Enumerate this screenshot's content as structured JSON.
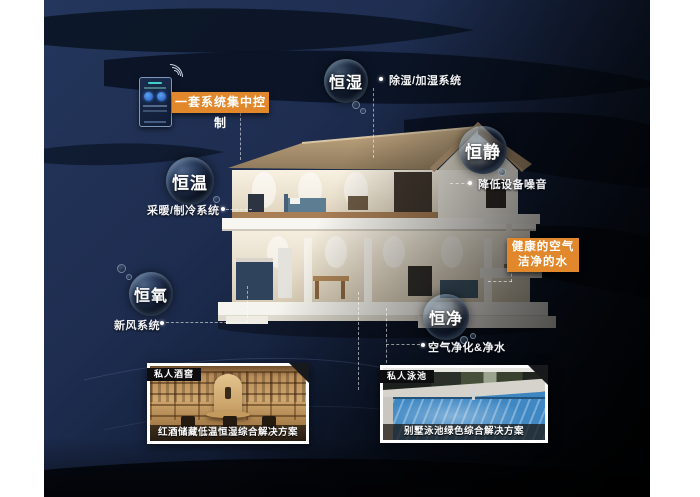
{
  "colors": {
    "accent_orange": "#e2882c",
    "background_navy": "#1e2d50",
    "background_black": "#05090f"
  },
  "control": {
    "label": "一套系统集中控制"
  },
  "callout": {
    "line1": "健康的空气",
    "line2": "洁净的水"
  },
  "bubbles": [
    {
      "label": "恒湿",
      "note": "除湿/加湿系统"
    },
    {
      "label": "恒静",
      "note": "降低设备噪音"
    },
    {
      "label": "恒温",
      "note": "采暖/制冷系统"
    },
    {
      "label": "恒氧",
      "note": "新风系统"
    },
    {
      "label": "恒净",
      "note": "空气净化&净水"
    }
  ],
  "photos": [
    {
      "tag": "私人酒窖",
      "caption": "红酒储藏低温恒湿综合解决方案"
    },
    {
      "tag": "私人泳池",
      "caption": "别墅泳池绿色综合解决方案"
    }
  ]
}
